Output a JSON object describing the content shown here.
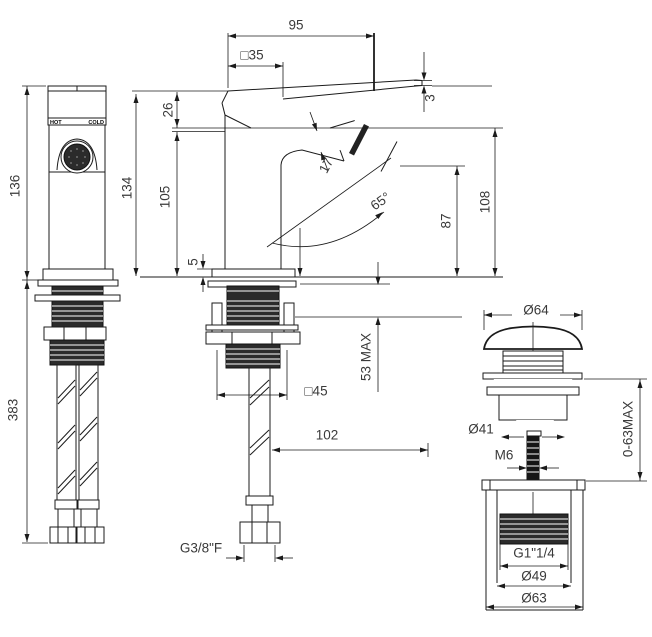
{
  "drawing": {
    "type": "faucet technical drawing",
    "views": {
      "front": "bidet mixer front view with supply hoses",
      "side": "bidet mixer side view with mounting shank",
      "drain": "pop-up waste drain assembly"
    }
  },
  "labels": {
    "hot": "HOT",
    "cold": "COLD",
    "hose_thread": "G3/8\"F",
    "waste_thread": "G1\"1/4"
  },
  "dims": {
    "spout_reach": "95",
    "body_square": "□35",
    "lever_tip_thickness": "3",
    "front_height": "136",
    "total_height": "383",
    "side_height": "134",
    "lever_to_spout": "26",
    "spout_to_deck": "105",
    "base_plate_height": "5",
    "spout_section": "17",
    "spray_angle": "65°",
    "outlet_height": "87",
    "spout_top_height": "108",
    "deck_thickness_max": "53 MAX",
    "base_square": "□45",
    "hose_offset": "102",
    "cap_diameter": "Ø64",
    "drain_body_diameter": "Ø41",
    "rod_thread": "M6",
    "mounting_range": "0-63MAX",
    "waste_inner_diameter": "Ø49",
    "waste_outer_diameter": "Ø63"
  }
}
